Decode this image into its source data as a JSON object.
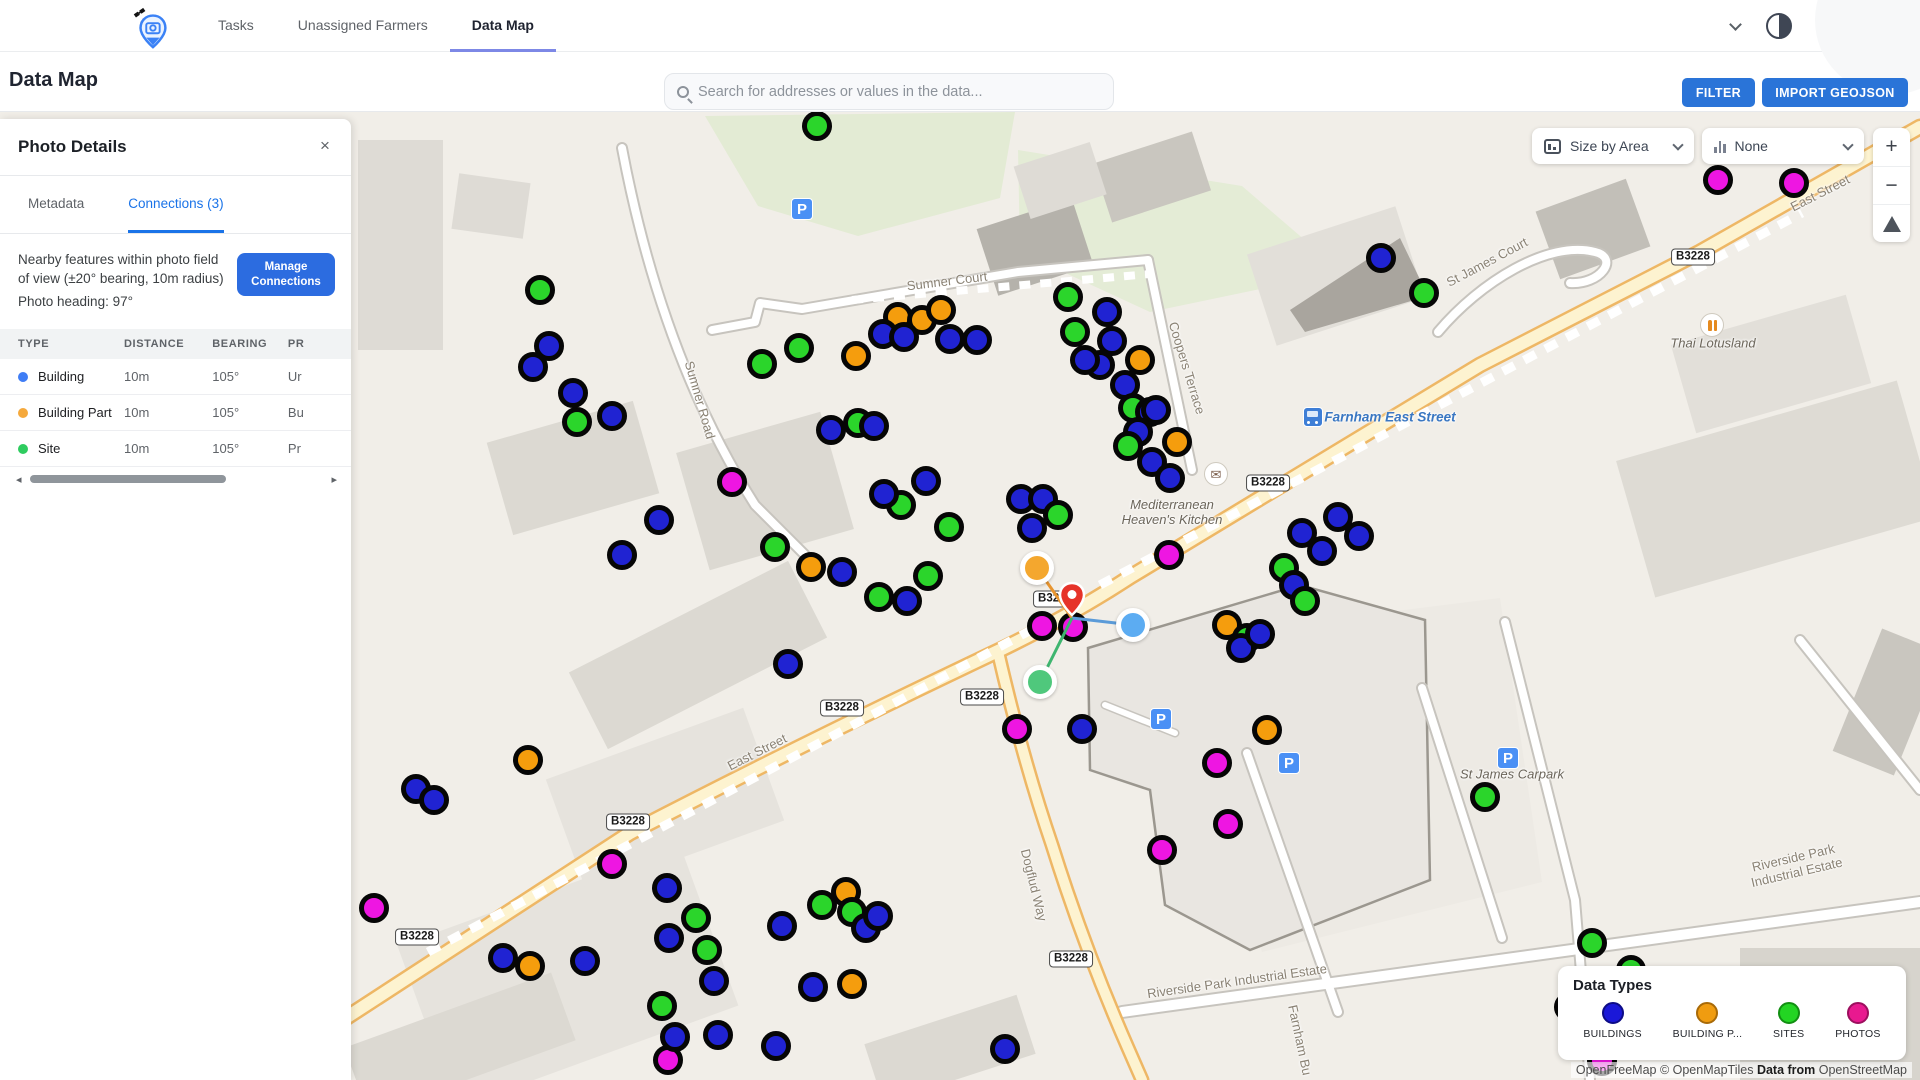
{
  "navbar": {
    "tabs": [
      {
        "label": "Tasks",
        "active": false
      },
      {
        "label": "Unassigned Farmers",
        "active": false
      },
      {
        "label": "Data Map",
        "active": true
      }
    ]
  },
  "header": {
    "title": "Data Map",
    "search_placeholder": "Search for addresses or values in the data...",
    "filter_label": "FILTER",
    "import_label": "IMPORT GEOJSON"
  },
  "panel": {
    "title": "Photo Details",
    "close_label": "×",
    "tabs": [
      {
        "label": "Metadata",
        "active": false
      },
      {
        "label": "Connections (3)",
        "active": true
      }
    ],
    "description_line": "Nearby features within photo field of view (±20° bearing, 10m radius)",
    "heading_line": "Photo heading: 97°",
    "manage_button": "Manage Connections",
    "table": {
      "headers": [
        "TYPE",
        "DISTANCE",
        "BEARING",
        "PR"
      ],
      "rows": [
        {
          "type": "Building",
          "dot_color": "#3f7df5",
          "distance": "10m",
          "bearing": "105°",
          "preview": "Ur"
        },
        {
          "type": "Building Part",
          "dot_color": "#f5a93c",
          "distance": "10m",
          "bearing": "105°",
          "preview": "Bu"
        },
        {
          "type": "Site",
          "dot_color": "#2ecc5f",
          "distance": "10m",
          "bearing": "105°",
          "preview": "Pr"
        }
      ]
    },
    "scroll_left": "◂",
    "scroll_right": "▸"
  },
  "map": {
    "controls": {
      "size_by_label": "Size by Area",
      "color_by_label": "None",
      "zoom_in": "+",
      "zoom_out": "−"
    },
    "legend": {
      "title": "Data Types",
      "items": [
        {
          "label": "BUILDINGS",
          "color": "#1a18d8",
          "ring": "#0d0c86"
        },
        {
          "label": "BUILDING P...",
          "color": "#f09c10",
          "ring": "#a86a08"
        },
        {
          "label": "SITES",
          "color": "#23d523",
          "ring": "#128f12"
        },
        {
          "label": "PHOTOS",
          "color": "#e8198f",
          "ring": "#9c0f5e"
        }
      ]
    },
    "attribution": {
      "part1": "OpenFreeMap © OpenMapTiles ",
      "part2": "Data from",
      "part3": " OpenStreetMap"
    },
    "marker_colors": {
      "b": "#2023d2",
      "g": "#2bd52b",
      "o": "#f59d0d",
      "m": "#ee16e2"
    },
    "labels": [
      {
        "text": "Sumner Court",
        "x": 947,
        "y": 281,
        "rot": -7,
        "cls": ""
      },
      {
        "text": "Sumner Road",
        "x": 700,
        "y": 400,
        "rot": 74,
        "cls": ""
      },
      {
        "text": "Coopers Terrace",
        "x": 1187,
        "y": 368,
        "rot": 73,
        "cls": ""
      },
      {
        "text": "St James Court",
        "x": 1487,
        "y": 262,
        "rot": -28,
        "cls": ""
      },
      {
        "text": "East Street",
        "x": 1820,
        "y": 193,
        "rot": -27,
        "cls": ""
      },
      {
        "text": "East Street",
        "x": 757,
        "y": 752,
        "rot": -27,
        "cls": ""
      },
      {
        "text": "Dogflud Way",
        "x": 1034,
        "y": 885,
        "rot": 76,
        "cls": ""
      },
      {
        "text": "Riverside Park Industrial Estate",
        "x": 1237,
        "y": 981,
        "rot": -8,
        "cls": ""
      },
      {
        "text": "Riverside Park Industrial Estate",
        "x": 1795,
        "y": 865,
        "rot": -13,
        "cls": ""
      },
      {
        "text": "Farnham Bu",
        "x": 1300,
        "y": 1040,
        "rot": 78,
        "cls": ""
      },
      {
        "text": "Mediterranean\nHeaven's Kitchen",
        "x": 1172,
        "y": 512,
        "rot": 0,
        "cls": "place"
      },
      {
        "text": "Thai Lotusland",
        "x": 1713,
        "y": 343,
        "rot": 0,
        "cls": "place"
      },
      {
        "text": "St James Carpark",
        "x": 1512,
        "y": 774,
        "rot": 0,
        "cls": "place"
      },
      {
        "text": "Farnham East Street",
        "x": 1390,
        "y": 417,
        "rot": 0,
        "cls": "transit"
      }
    ],
    "badges": [
      {
        "text": "B3228",
        "x": 1693,
        "y": 257
      },
      {
        "text": "B3228",
        "x": 1268,
        "y": 483
      },
      {
        "text": "B3228",
        "x": 1055,
        "y": 599
      },
      {
        "text": "B3228",
        "x": 842,
        "y": 708
      },
      {
        "text": "B3228",
        "x": 982,
        "y": 697
      },
      {
        "text": "B3228",
        "x": 628,
        "y": 822
      },
      {
        "text": "B3228",
        "x": 417,
        "y": 937
      },
      {
        "text": "B3228",
        "x": 1071,
        "y": 959
      }
    ],
    "poi": [
      {
        "type": "parking",
        "x": 802,
        "y": 209
      },
      {
        "type": "parking",
        "x": 1161,
        "y": 719
      },
      {
        "type": "parking",
        "x": 1289,
        "y": 763
      },
      {
        "type": "parking",
        "x": 1508,
        "y": 758
      },
      {
        "type": "mail",
        "x": 1216,
        "y": 474
      },
      {
        "type": "restaurant",
        "x": 1712,
        "y": 325
      },
      {
        "type": "bus",
        "x": 1313,
        "y": 417
      }
    ],
    "markers": [
      {
        "x": 540,
        "y": 290,
        "c": "g"
      },
      {
        "x": 549,
        "y": 346,
        "c": "b"
      },
      {
        "x": 533,
        "y": 367,
        "c": "b"
      },
      {
        "x": 573,
        "y": 393,
        "c": "b"
      },
      {
        "x": 612,
        "y": 416,
        "c": "b"
      },
      {
        "x": 577,
        "y": 422,
        "c": "g"
      },
      {
        "x": 659,
        "y": 520,
        "c": "b"
      },
      {
        "x": 622,
        "y": 555,
        "c": "b"
      },
      {
        "x": 817,
        "y": 126,
        "c": "g"
      },
      {
        "x": 762,
        "y": 364,
        "c": "g"
      },
      {
        "x": 799,
        "y": 348,
        "c": "g"
      },
      {
        "x": 831,
        "y": 430,
        "c": "b"
      },
      {
        "x": 858,
        "y": 423,
        "c": "g"
      },
      {
        "x": 874,
        "y": 426,
        "c": "b"
      },
      {
        "x": 732,
        "y": 482,
        "c": "m"
      },
      {
        "x": 898,
        "y": 317,
        "c": "o"
      },
      {
        "x": 922,
        "y": 320,
        "c": "o"
      },
      {
        "x": 941,
        "y": 310,
        "c": "o"
      },
      {
        "x": 883,
        "y": 334,
        "c": "b"
      },
      {
        "x": 904,
        "y": 337,
        "c": "b"
      },
      {
        "x": 856,
        "y": 356,
        "c": "o"
      },
      {
        "x": 950,
        "y": 339,
        "c": "b"
      },
      {
        "x": 977,
        "y": 340,
        "c": "b"
      },
      {
        "x": 926,
        "y": 481,
        "c": "b"
      },
      {
        "x": 901,
        "y": 505,
        "c": "g"
      },
      {
        "x": 884,
        "y": 494,
        "c": "b"
      },
      {
        "x": 775,
        "y": 547,
        "c": "g"
      },
      {
        "x": 811,
        "y": 567,
        "c": "o"
      },
      {
        "x": 842,
        "y": 572,
        "c": "b"
      },
      {
        "x": 879,
        "y": 597,
        "c": "g"
      },
      {
        "x": 907,
        "y": 601,
        "c": "b"
      },
      {
        "x": 928,
        "y": 576,
        "c": "g"
      },
      {
        "x": 1021,
        "y": 499,
        "c": "b"
      },
      {
        "x": 1043,
        "y": 499,
        "c": "b"
      },
      {
        "x": 1058,
        "y": 515,
        "c": "g"
      },
      {
        "x": 1032,
        "y": 528,
        "c": "b"
      },
      {
        "x": 949,
        "y": 527,
        "c": "g"
      },
      {
        "x": 1068,
        "y": 297,
        "c": "g"
      },
      {
        "x": 1075,
        "y": 332,
        "c": "g"
      },
      {
        "x": 1107,
        "y": 312,
        "c": "b"
      },
      {
        "x": 1112,
        "y": 341,
        "c": "b"
      },
      {
        "x": 1100,
        "y": 365,
        "c": "b"
      },
      {
        "x": 1140,
        "y": 360,
        "c": "o"
      },
      {
        "x": 1125,
        "y": 385,
        "c": "b"
      },
      {
        "x": 1133,
        "y": 408,
        "c": "g"
      },
      {
        "x": 1150,
        "y": 412,
        "c": "b"
      },
      {
        "x": 1085,
        "y": 360,
        "c": "b"
      },
      {
        "x": 1156,
        "y": 410,
        "c": "b"
      },
      {
        "x": 1138,
        "y": 432,
        "c": "b"
      },
      {
        "x": 1177,
        "y": 442,
        "c": "o"
      },
      {
        "x": 1152,
        "y": 462,
        "c": "b"
      },
      {
        "x": 1170,
        "y": 478,
        "c": "b"
      },
      {
        "x": 1128,
        "y": 446,
        "c": "g"
      },
      {
        "x": 1381,
        "y": 258,
        "c": "b"
      },
      {
        "x": 1424,
        "y": 293,
        "c": "g"
      },
      {
        "x": 1718,
        "y": 180,
        "c": "m"
      },
      {
        "x": 1794,
        "y": 183,
        "c": "m"
      },
      {
        "x": 1338,
        "y": 517,
        "c": "b"
      },
      {
        "x": 1359,
        "y": 536,
        "c": "b"
      },
      {
        "x": 1302,
        "y": 533,
        "c": "b"
      },
      {
        "x": 1322,
        "y": 551,
        "c": "b"
      },
      {
        "x": 1284,
        "y": 568,
        "c": "g"
      },
      {
        "x": 1294,
        "y": 585,
        "c": "b"
      },
      {
        "x": 1305,
        "y": 601,
        "c": "g"
      },
      {
        "x": 1169,
        "y": 555,
        "c": "m"
      },
      {
        "x": 1227,
        "y": 625,
        "c": "o"
      },
      {
        "x": 1247,
        "y": 638,
        "c": "g"
      },
      {
        "x": 1241,
        "y": 648,
        "c": "b"
      },
      {
        "x": 1260,
        "y": 634,
        "c": "b"
      },
      {
        "x": 1017,
        "y": 729,
        "c": "m"
      },
      {
        "x": 1082,
        "y": 729,
        "c": "b"
      },
      {
        "x": 1217,
        "y": 763,
        "c": "m"
      },
      {
        "x": 1267,
        "y": 730,
        "c": "o"
      },
      {
        "x": 1228,
        "y": 824,
        "c": "m"
      },
      {
        "x": 1162,
        "y": 850,
        "c": "m"
      },
      {
        "x": 1042,
        "y": 626,
        "c": "m"
      },
      {
        "x": 1073,
        "y": 627,
        "c": "m"
      },
      {
        "x": 1485,
        "y": 797,
        "c": "g"
      },
      {
        "x": 528,
        "y": 760,
        "c": "o"
      },
      {
        "x": 416,
        "y": 789,
        "c": "b"
      },
      {
        "x": 434,
        "y": 800,
        "c": "b"
      },
      {
        "x": 374,
        "y": 908,
        "c": "m"
      },
      {
        "x": 503,
        "y": 958,
        "c": "b"
      },
      {
        "x": 530,
        "y": 966,
        "c": "o"
      },
      {
        "x": 585,
        "y": 961,
        "c": "b"
      },
      {
        "x": 612,
        "y": 864,
        "c": "m"
      },
      {
        "x": 667,
        "y": 888,
        "c": "b"
      },
      {
        "x": 696,
        "y": 918,
        "c": "g"
      },
      {
        "x": 669,
        "y": 938,
        "c": "b"
      },
      {
        "x": 707,
        "y": 950,
        "c": "g"
      },
      {
        "x": 782,
        "y": 926,
        "c": "b"
      },
      {
        "x": 714,
        "y": 981,
        "c": "b"
      },
      {
        "x": 662,
        "y": 1006,
        "c": "g"
      },
      {
        "x": 718,
        "y": 1035,
        "c": "b"
      },
      {
        "x": 668,
        "y": 1060,
        "c": "m"
      },
      {
        "x": 776,
        "y": 1046,
        "c": "b"
      },
      {
        "x": 822,
        "y": 905,
        "c": "g"
      },
      {
        "x": 846,
        "y": 892,
        "c": "o"
      },
      {
        "x": 852,
        "y": 912,
        "c": "g"
      },
      {
        "x": 866,
        "y": 928,
        "c": "b"
      },
      {
        "x": 878,
        "y": 916,
        "c": "b"
      },
      {
        "x": 788,
        "y": 664,
        "c": "b"
      },
      {
        "x": 813,
        "y": 987,
        "c": "b"
      },
      {
        "x": 852,
        "y": 984,
        "c": "o"
      },
      {
        "x": 675,
        "y": 1037,
        "c": "b"
      },
      {
        "x": 1005,
        "y": 1049,
        "c": "b"
      },
      {
        "x": 1592,
        "y": 943,
        "c": "g"
      },
      {
        "x": 1631,
        "y": 970,
        "c": "g"
      },
      {
        "x": 1569,
        "y": 1007,
        "c": "b"
      },
      {
        "x": 1602,
        "y": 1061,
        "c": "m"
      }
    ],
    "selection": {
      "pin": {
        "x": 1072,
        "y": 622
      },
      "connections": [
        {
          "x": 1037,
          "y": 568,
          "color": "#f4a72e",
          "line": "#e8952f"
        },
        {
          "x": 1133,
          "y": 625,
          "color": "#5cacf2",
          "line": "#5b9bd8"
        },
        {
          "x": 1040,
          "y": 682,
          "color": "#4fc87c",
          "line": "#3eb56f"
        }
      ]
    }
  }
}
